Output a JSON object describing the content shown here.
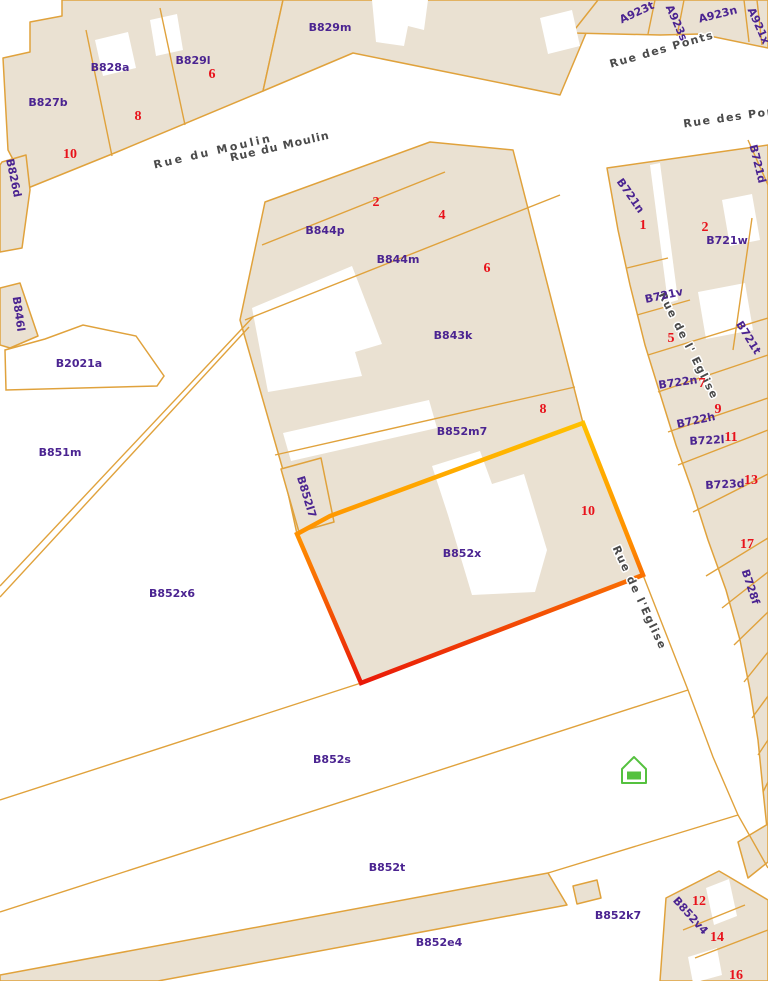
{
  "map": {
    "title": "cadastral-parcel-map",
    "colors": {
      "background": "#ffffff",
      "parcel_fill": "#EAE1D2",
      "boundary": "#E0A23C",
      "label": "#4B2491",
      "number": "#E8121B",
      "street": "#4A4A4A",
      "poi": "#55C13F",
      "highlight_stops": [
        [
          0,
          "#FFC400"
        ],
        [
          0.45,
          "#FF8F00"
        ],
        [
          1,
          "#E81309"
        ]
      ]
    },
    "parcels": [
      {
        "name": "block-rue-du-moulin",
        "points": "28,188 117,152 263,91 283,0 62,0 62,16 30,22 30,52 3,58 8,150"
      },
      {
        "name": "B829m",
        "points": "283,0 600,0 560,95 353,53 263,91"
      },
      {
        "name": "B826d",
        "points": "2,162 26,155 30,190 22,248 0,252 0,165"
      },
      {
        "name": "A923-band",
        "points": "572,33 598,0 768,0 768,48 700,34 660,35"
      },
      {
        "name": "B846l",
        "points": "0,288 20,283 38,336 10,348 0,345"
      },
      {
        "name": "center-block-B844-B852",
        "points": "265,202 430,142 513,150 583,423 643,575 361,683 297,534 283,470 240,320"
      },
      {
        "name": "right-block-B721-B728",
        "points": "607,168 768,145 768,838 763,790 758,740 750,690 740,640 726,590 708,540 692,490 676,445 662,400 645,345 630,285 618,230"
      },
      {
        "name": "B852l7",
        "points": "281,469 321,458 334,522 299,532"
      },
      {
        "name": "B852e4",
        "points": "0,975 548,873 567,905 158,981 0,981"
      },
      {
        "name": "B852v4-block",
        "points": "666,898 719,871 731,878 768,900 768,981 660,981"
      },
      {
        "name": "strip-near-street-exit",
        "points": "738,842 768,824 768,862 748,878"
      },
      {
        "name": "small-building-B852k7",
        "points": "573,886 597,880 601,898 577,904"
      }
    ],
    "white_cutouts": [
      {
        "points": "95,40 128,32 136,68 103,76"
      },
      {
        "points": "150,20 177,14 183,50 156,56"
      },
      {
        "points": "372,0 428,0 424,30 408,26 404,46 376,42"
      },
      {
        "points": "540,18 572,10 580,46 548,54"
      },
      {
        "points": "252,308 352,266 382,344 355,352 362,376 268,392"
      },
      {
        "points": "283,433 429,400 437,428 291,461"
      },
      {
        "points": "432,466 480,451 492,484 524,474 547,550 535,592 472,595 448,515"
      },
      {
        "points": "650,165 660,163 678,300 668,303"
      },
      {
        "points": "722,200 752,194 760,240 730,246"
      },
      {
        "points": "698,292 745,283 753,330 706,339"
      },
      {
        "points": "706,888 729,879 737,916 714,925"
      },
      {
        "points": "688,957 717,948 722,975 693,983"
      }
    ],
    "outlined_white": [
      {
        "name": "B2021a",
        "points": "5,350 45,339 83,325 136,336 164,376 157,386 6,390"
      }
    ],
    "lines": [
      {
        "points": "112,156 86,30"
      },
      {
        "points": "185,125 160,8"
      },
      {
        "points": "262,245 445,172"
      },
      {
        "points": "245,320 560,195"
      },
      {
        "points": "275,455 575,387"
      },
      {
        "points": "253,317 0,586"
      },
      {
        "points": "249,327 0,597"
      },
      {
        "points": "0,800 361,683 643,575"
      },
      {
        "points": "0,912 688,690"
      },
      {
        "points": "643,575 688,690 713,757 738,815 768,868"
      },
      {
        "points": "738,815 548,873"
      },
      {
        "points": "627,268 668,258"
      },
      {
        "points": "637,315 690,300"
      },
      {
        "points": "648,355 768,318"
      },
      {
        "points": "658,392 768,355"
      },
      {
        "points": "668,432 768,398"
      },
      {
        "points": "678,465 768,430"
      },
      {
        "points": "693,512 768,474"
      },
      {
        "points": "706,576 768,538"
      },
      {
        "points": "722,608 768,572"
      },
      {
        "points": "734,645 768,612"
      },
      {
        "points": "744,682 768,652"
      },
      {
        "points": "752,718 768,696"
      },
      {
        "points": "758,755 768,740"
      },
      {
        "points": "763,792 768,782"
      },
      {
        "points": "748,140 768,185"
      },
      {
        "points": "752,218 733,350"
      },
      {
        "points": "655,0 648,34"
      },
      {
        "points": "684,0 677,36"
      },
      {
        "points": "744,0 749,42"
      },
      {
        "points": "757,0 762,45"
      },
      {
        "points": "683,930 745,905"
      },
      {
        "points": "695,958 768,930"
      }
    ],
    "highlight": {
      "points": "583,423 643,575 361,683 297,534 330,516",
      "stroke_width": 4.5,
      "gradient": {
        "x1": 470,
        "y1": 415,
        "x2": 470,
        "y2": 690
      }
    },
    "parcel_labels": [
      {
        "text": "B829m",
        "x": 330,
        "y": 28,
        "rot": 0
      },
      {
        "text": "B828a",
        "x": 110,
        "y": 68,
        "rot": 0
      },
      {
        "text": "B829l",
        "x": 193,
        "y": 61,
        "rot": 0
      },
      {
        "text": "B827b",
        "x": 48,
        "y": 103,
        "rot": 0
      },
      {
        "text": "B826d",
        "x": 13,
        "y": 178,
        "rot": 78
      },
      {
        "text": "B846l",
        "x": 18,
        "y": 314,
        "rot": 82
      },
      {
        "text": "B2021a",
        "x": 79,
        "y": 364,
        "rot": 0
      },
      {
        "text": "B851m",
        "x": 60,
        "y": 453,
        "rot": 0
      },
      {
        "text": "B852x6",
        "x": 172,
        "y": 594,
        "rot": 0
      },
      {
        "text": "B844p",
        "x": 325,
        "y": 231,
        "rot": 0
      },
      {
        "text": "B844m",
        "x": 398,
        "y": 260,
        "rot": 0
      },
      {
        "text": "B843k",
        "x": 453,
        "y": 336,
        "rot": 0
      },
      {
        "text": "B852m7",
        "x": 462,
        "y": 432,
        "rot": 0
      },
      {
        "text": "B852l7",
        "x": 306,
        "y": 497,
        "rot": 73
      },
      {
        "text": "B852x",
        "x": 462,
        "y": 554,
        "rot": 0
      },
      {
        "text": "B852s",
        "x": 332,
        "y": 760,
        "rot": 0
      },
      {
        "text": "B852t",
        "x": 387,
        "y": 868,
        "rot": 0
      },
      {
        "text": "B852e4",
        "x": 439,
        "y": 943,
        "rot": 0
      },
      {
        "text": "B852k7",
        "x": 618,
        "y": 916,
        "rot": 0
      },
      {
        "text": "B852v4",
        "x": 690,
        "y": 916,
        "rot": 48
      },
      {
        "text": "A923t",
        "x": 637,
        "y": 13,
        "rot": -25
      },
      {
        "text": "A923s",
        "x": 676,
        "y": 23,
        "rot": 66
      },
      {
        "text": "A923n",
        "x": 718,
        "y": 15,
        "rot": -14
      },
      {
        "text": "A921x",
        "x": 758,
        "y": 26,
        "rot": 66
      },
      {
        "text": "B721n",
        "x": 630,
        "y": 196,
        "rot": 55
      },
      {
        "text": "B721w",
        "x": 727,
        "y": 241,
        "rot": 0
      },
      {
        "text": "B721v",
        "x": 664,
        "y": 296,
        "rot": -12
      },
      {
        "text": "B721t",
        "x": 748,
        "y": 338,
        "rot": 58
      },
      {
        "text": "B721d",
        "x": 757,
        "y": 164,
        "rot": 76
      },
      {
        "text": "B722n",
        "x": 678,
        "y": 383,
        "rot": -8
      },
      {
        "text": "B722h",
        "x": 696,
        "y": 421,
        "rot": -12
      },
      {
        "text": "B722l",
        "x": 707,
        "y": 441,
        "rot": -3
      },
      {
        "text": "B723d",
        "x": 725,
        "y": 485,
        "rot": -3
      },
      {
        "text": "B728f",
        "x": 750,
        "y": 587,
        "rot": 72
      }
    ],
    "house_numbers": [
      {
        "text": "6",
        "x": 212,
        "y": 75
      },
      {
        "text": "8",
        "x": 138,
        "y": 117
      },
      {
        "text": "10",
        "x": 70,
        "y": 155
      },
      {
        "text": "2",
        "x": 376,
        "y": 203
      },
      {
        "text": "4",
        "x": 442,
        "y": 216
      },
      {
        "text": "6",
        "x": 487,
        "y": 269
      },
      {
        "text": "8",
        "x": 543,
        "y": 410
      },
      {
        "text": "10",
        "x": 588,
        "y": 512
      },
      {
        "text": "1",
        "x": 643,
        "y": 226
      },
      {
        "text": "2",
        "x": 705,
        "y": 228
      },
      {
        "text": "5",
        "x": 671,
        "y": 339
      },
      {
        "text": "7",
        "x": 702,
        "y": 384
      },
      {
        "text": "9",
        "x": 718,
        "y": 410
      },
      {
        "text": "11",
        "x": 731,
        "y": 438
      },
      {
        "text": "13",
        "x": 751,
        "y": 481
      },
      {
        "text": "17",
        "x": 747,
        "y": 545
      },
      {
        "text": "12",
        "x": 699,
        "y": 902
      },
      {
        "text": "14",
        "x": 717,
        "y": 938
      },
      {
        "text": "16",
        "x": 736,
        "y": 976
      }
    ],
    "street_labels": [
      {
        "text": "Rue  du  Moulin",
        "x": 213,
        "y": 152,
        "rot": -13,
        "ls": 2.5
      },
      {
        "text": "Rue du Moulin",
        "x": 280,
        "y": 147,
        "rot": -13,
        "ls": 1
      },
      {
        "text": "Rue des Ponts",
        "x": 662,
        "y": 50,
        "rot": -16,
        "ls": 1.5
      },
      {
        "text": "Rue des Ponts",
        "x": 737,
        "y": 117,
        "rot": -8,
        "ls": 1.5
      },
      {
        "text": "Rue de l' Eglise",
        "x": 688,
        "y": 346,
        "rot": 63,
        "ls": 1.5
      },
      {
        "text": "Rue de l'Eglise",
        "x": 639,
        "y": 598,
        "rot": 65,
        "ls": 1.5
      }
    ],
    "poi": {
      "house_outline": "622,769 634,757 646,769 646,783 622,783",
      "house_door": {
        "x": 627,
        "y": 771.5,
        "w": 14,
        "h": 8
      }
    }
  }
}
